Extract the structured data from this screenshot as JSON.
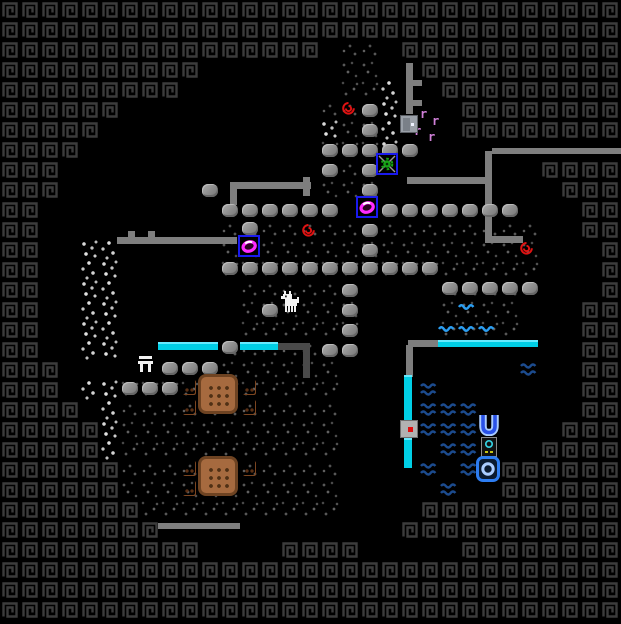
{
  "app": {
    "view": "fortress-local-map"
  },
  "grid": {
    "tile_px": 20,
    "cols": 31,
    "rows": 31,
    "width_px": 621,
    "height_px": 610
  },
  "palette": {
    "background": "#000000",
    "border_glyph": "#3c3c3c",
    "rough_floor_speckle": "#555555",
    "white_floor_speckle": "#d4d4d4",
    "boulder_gray": "#8f8f8f",
    "wall_gray": "#7e7e7e",
    "wall_dark_gray": "#4a4a4a",
    "glass_cyan": "#00cfe6",
    "water_dark_blue": "#1c4b8e",
    "water_bright_blue": "#2b9df0",
    "table_brown": "#a66a3f",
    "stool_brown": "#a05c30",
    "building_box_blue": "#1a1aee",
    "gear_green": "#16a416",
    "ring_magenta": "#ff2bff",
    "spiral_red": "#e01212",
    "vermin_pink": "#d080d8",
    "door_gray": "#9aa0a8",
    "well_blue": "#2a52e8",
    "well_pale_blue": "#aaccff",
    "item_cyan": "#35d0e0",
    "item_yellow": "#d8d818",
    "creature_white": "#f2f2f2"
  },
  "legend": {
    "#": "border-wall-tile",
    ".": "open-black-tile",
    "s": "rough-stone-floor-tile",
    "w": "white-mineral-floor-tile"
  },
  "tilemap": [
    "###############################",
    "###############################",
    "################.ss.###########",
    "##########.......ss..##########",
    "#########........ssw..#########",
    "######..........sssw...########",
    "#####...........wssw...########",
    "####............sssw...........",
    "###.............sss........####",
    "###.............sss.........###",
    "##...........................##",
    "##.........ssssssssssssssss..##",
    "##..ww.....ssssssssssssssss...#",
    "##..ww.....ssssssssssssssss...#",
    "##..ww......ssssss....ssss....#",
    "##..ww......ssssss....ssss...##",
    "##..ww......ssssss....ssss...##",
    "##..ww.....sssssss...........##",
    "###........ssssss............##",
    "###.wwsssssssssss............##",
    "####.wsssssssssss............##",
    "#####wsssssssssss...........###",
    "#####wsssssssssss..........####",
    "######sssssssssss........######",
    "######sssssssssss........######",
    "#######ssssssssss....##########",
    "########............###########",
    "##########....####.....########",
    "###############################",
    "###############################",
    "###############################"
  ],
  "objects": {
    "boulders": [
      [
        362,
        104
      ],
      [
        362,
        124
      ],
      [
        322,
        144
      ],
      [
        342,
        144
      ],
      [
        362,
        144
      ],
      [
        382,
        144
      ],
      [
        402,
        144
      ],
      [
        322,
        164
      ],
      [
        362,
        164
      ],
      [
        202,
        184
      ],
      [
        362,
        184
      ],
      [
        222,
        204
      ],
      [
        242,
        204
      ],
      [
        262,
        204
      ],
      [
        282,
        204
      ],
      [
        302,
        204
      ],
      [
        322,
        204
      ],
      [
        382,
        204
      ],
      [
        402,
        204
      ],
      [
        422,
        204
      ],
      [
        442,
        204
      ],
      [
        462,
        204
      ],
      [
        482,
        204
      ],
      [
        502,
        204
      ],
      [
        242,
        222
      ],
      [
        362,
        224
      ],
      [
        362,
        244
      ],
      [
        222,
        262
      ],
      [
        242,
        262
      ],
      [
        262,
        262
      ],
      [
        282,
        262
      ],
      [
        302,
        262
      ],
      [
        322,
        262
      ],
      [
        342,
        262
      ],
      [
        362,
        262
      ],
      [
        382,
        262
      ],
      [
        402,
        262
      ],
      [
        422,
        262
      ],
      [
        442,
        282
      ],
      [
        462,
        282
      ],
      [
        482,
        282
      ],
      [
        502,
        282
      ],
      [
        522,
        282
      ],
      [
        342,
        284
      ],
      [
        342,
        304
      ],
      [
        342,
        324
      ],
      [
        262,
        304
      ],
      [
        322,
        344
      ],
      [
        342,
        344
      ],
      [
        222,
        341
      ],
      [
        162,
        362
      ],
      [
        182,
        362
      ],
      [
        202,
        362
      ],
      [
        122,
        382
      ],
      [
        142,
        382
      ],
      [
        162,
        382
      ]
    ],
    "gray_walls": [
      [
        230,
        182,
        81,
        7
      ],
      [
        230,
        182,
        7,
        23
      ],
      [
        303,
        177,
        7,
        19
      ],
      [
        117,
        237,
        120,
        7
      ],
      [
        128,
        231,
        7,
        6
      ],
      [
        148,
        231,
        7,
        6
      ],
      [
        406,
        63,
        7,
        51
      ],
      [
        413,
        80,
        9,
        6
      ],
      [
        413,
        100,
        9,
        6
      ],
      [
        407,
        177,
        80,
        7
      ],
      [
        485,
        151,
        7,
        92
      ],
      [
        492,
        236,
        31,
        7
      ],
      [
        492,
        148,
        129,
        6
      ],
      [
        408,
        340,
        30,
        7
      ],
      [
        406,
        345,
        7,
        32
      ],
      [
        158,
        523,
        82,
        6
      ]
    ],
    "dark_walls": [
      [
        277,
        343,
        33,
        7
      ],
      [
        303,
        343,
        7,
        35
      ]
    ],
    "cyan_walls": [
      [
        158,
        342,
        60,
        8
      ],
      [
        240,
        342,
        38,
        8
      ],
      [
        438,
        340,
        100,
        7
      ],
      [
        404,
        375,
        8,
        47
      ],
      [
        404,
        438,
        8,
        30
      ]
    ],
    "dark_waves": [
      [
        520,
        362
      ],
      [
        420,
        382
      ],
      [
        420,
        402
      ],
      [
        440,
        402
      ],
      [
        460,
        402
      ],
      [
        420,
        422
      ],
      [
        440,
        422
      ],
      [
        460,
        422
      ],
      [
        440,
        442
      ],
      [
        460,
        442
      ],
      [
        420,
        462
      ],
      [
        460,
        462
      ],
      [
        440,
        482
      ]
    ],
    "bright_waves": [
      [
        458,
        296
      ],
      [
        438,
        318
      ],
      [
        458,
        318
      ],
      [
        478,
        318
      ]
    ],
    "red_spirals": [
      [
        340,
        100
      ],
      [
        300,
        222
      ],
      [
        518,
        240
      ]
    ],
    "pink_vermin": [
      [
        420,
        108
      ],
      [
        432,
        115
      ],
      [
        414,
        125
      ],
      [
        428,
        131
      ]
    ],
    "doors_plain": [
      [
        400,
        115
      ]
    ],
    "doors_marked": [
      [
        400,
        420
      ]
    ],
    "gear_assemblies": [
      [
        376,
        153
      ]
    ],
    "ring_buildings": [
      [
        238,
        235
      ],
      [
        356,
        196
      ]
    ],
    "wells": [
      [
        478,
        413
      ]
    ],
    "small_items": [
      [
        481,
        437
      ]
    ],
    "o_buildings": [
      [
        476,
        456
      ]
    ],
    "white_tables": [
      [
        138,
        356
      ]
    ],
    "tables": [
      [
        198,
        374
      ],
      [
        198,
        456
      ]
    ],
    "stools": [
      [
        183,
        380
      ],
      [
        183,
        400
      ],
      [
        243,
        380
      ],
      [
        243,
        400
      ],
      [
        183,
        461
      ],
      [
        183,
        481
      ],
      [
        243,
        461
      ]
    ],
    "creatures": [
      [
        281,
        291
      ]
    ]
  }
}
